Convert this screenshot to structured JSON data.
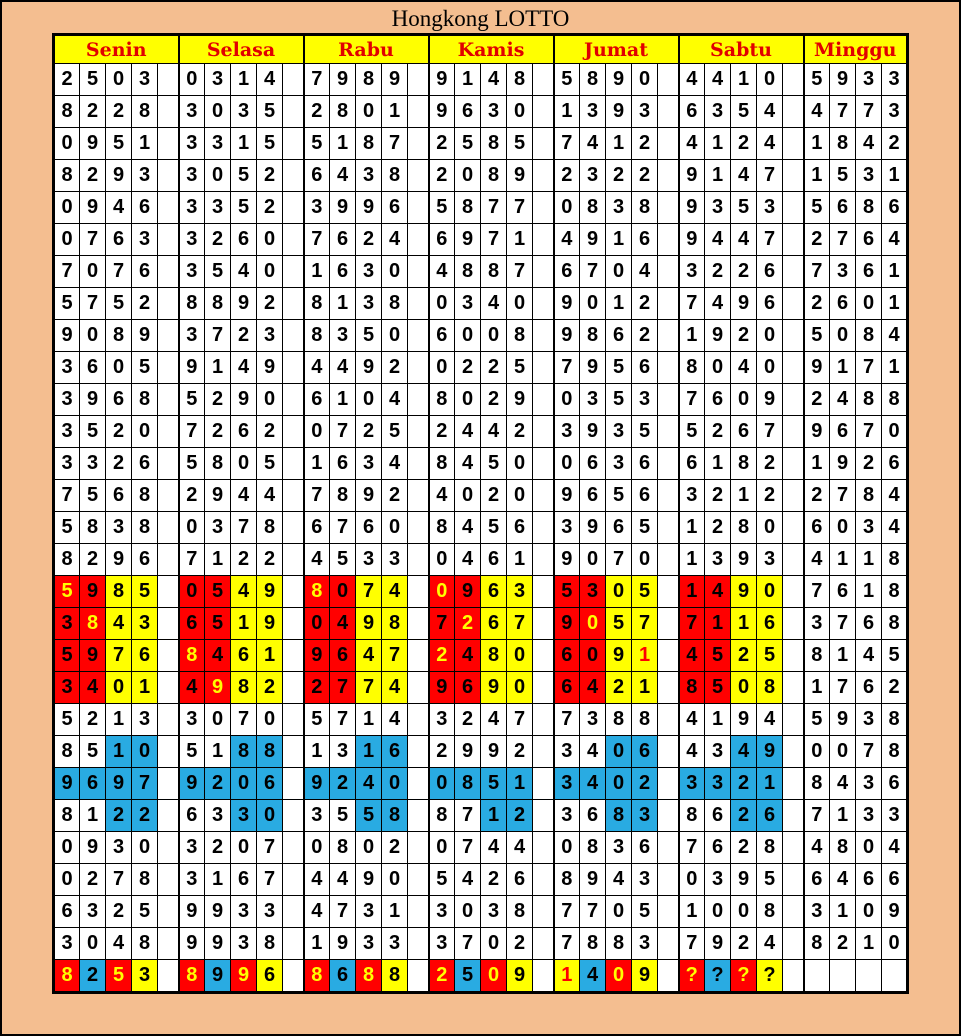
{
  "chart_data": {
    "type": "table",
    "title": "Hongkong LOTTO",
    "columns": [
      "Senin",
      "Selasa",
      "Rabu",
      "Kamis",
      "Jumat",
      "Sabtu",
      "Minggu"
    ],
    "cell_codes": {
      "bg": {
        "w": "white",
        "r": "red",
        "y": "yellow",
        "u": "blue"
      },
      "fg": {
        "k": "black",
        "y": "yellow",
        "r": "red"
      }
    },
    "colors": {
      "background": "#F4BE90",
      "grid": "#000000",
      "title_text": "#000000",
      "header_bg": "#FFFF00",
      "header_text": "#E10000",
      "cell_white": "#FFFFFF",
      "digit_text": "#000000",
      "highlight_red": "#FF0000",
      "highlight_yellow": "#FFFF00",
      "highlight_blue": "#29ABE2"
    },
    "rows": [
      [
        {
          "d": "2503"
        },
        {
          "d": "0314"
        },
        {
          "d": "7989"
        },
        {
          "d": "9148"
        },
        {
          "d": "5890"
        },
        {
          "d": "4410"
        },
        {
          "d": "5933"
        }
      ],
      [
        {
          "d": "8228"
        },
        {
          "d": "3035"
        },
        {
          "d": "2801"
        },
        {
          "d": "9630"
        },
        {
          "d": "1393"
        },
        {
          "d": "6354"
        },
        {
          "d": "4773"
        }
      ],
      [
        {
          "d": "0951"
        },
        {
          "d": "3315"
        },
        {
          "d": "5187"
        },
        {
          "d": "2585"
        },
        {
          "d": "7412"
        },
        {
          "d": "4124"
        },
        {
          "d": "1842"
        }
      ],
      [
        {
          "d": "8293"
        },
        {
          "d": "3052"
        },
        {
          "d": "6438"
        },
        {
          "d": "2089"
        },
        {
          "d": "2322"
        },
        {
          "d": "9147"
        },
        {
          "d": "1531"
        }
      ],
      [
        {
          "d": "0946"
        },
        {
          "d": "3352"
        },
        {
          "d": "3996"
        },
        {
          "d": "5877"
        },
        {
          "d": "0838"
        },
        {
          "d": "9353"
        },
        {
          "d": "5686"
        }
      ],
      [
        {
          "d": "0763"
        },
        {
          "d": "3260"
        },
        {
          "d": "7624"
        },
        {
          "d": "6971"
        },
        {
          "d": "4916"
        },
        {
          "d": "9447"
        },
        {
          "d": "2764"
        }
      ],
      [
        {
          "d": "7076"
        },
        {
          "d": "3540"
        },
        {
          "d": "1630"
        },
        {
          "d": "4887"
        },
        {
          "d": "6704"
        },
        {
          "d": "3226"
        },
        {
          "d": "7361"
        }
      ],
      [
        {
          "d": "5752"
        },
        {
          "d": "8892"
        },
        {
          "d": "8138"
        },
        {
          "d": "0340"
        },
        {
          "d": "9012"
        },
        {
          "d": "7496"
        },
        {
          "d": "2601"
        }
      ],
      [
        {
          "d": "9089"
        },
        {
          "d": "3723"
        },
        {
          "d": "8350"
        },
        {
          "d": "6008"
        },
        {
          "d": "9862"
        },
        {
          "d": "1920"
        },
        {
          "d": "5084"
        }
      ],
      [
        {
          "d": "3605"
        },
        {
          "d": "9149"
        },
        {
          "d": "4492"
        },
        {
          "d": "0225"
        },
        {
          "d": "7956"
        },
        {
          "d": "8040"
        },
        {
          "d": "9171"
        }
      ],
      [
        {
          "d": "3968"
        },
        {
          "d": "5290"
        },
        {
          "d": "6104"
        },
        {
          "d": "8029"
        },
        {
          "d": "0353"
        },
        {
          "d": "7609"
        },
        {
          "d": "2488"
        }
      ],
      [
        {
          "d": "3520"
        },
        {
          "d": "7262"
        },
        {
          "d": "0725"
        },
        {
          "d": "2442"
        },
        {
          "d": "3935"
        },
        {
          "d": "5267"
        },
        {
          "d": "9670"
        }
      ],
      [
        {
          "d": "3326"
        },
        {
          "d": "5805"
        },
        {
          "d": "1634"
        },
        {
          "d": "8450"
        },
        {
          "d": "0636"
        },
        {
          "d": "6182"
        },
        {
          "d": "1926"
        }
      ],
      [
        {
          "d": "7568"
        },
        {
          "d": "2944"
        },
        {
          "d": "7892"
        },
        {
          "d": "4020"
        },
        {
          "d": "9656"
        },
        {
          "d": "3212"
        },
        {
          "d": "2784"
        }
      ],
      [
        {
          "d": "5838"
        },
        {
          "d": "0378"
        },
        {
          "d": "6760"
        },
        {
          "d": "8456"
        },
        {
          "d": "3965"
        },
        {
          "d": "1280"
        },
        {
          "d": "6034"
        }
      ],
      [
        {
          "d": "8296"
        },
        {
          "d": "7122"
        },
        {
          "d": "4533"
        },
        {
          "d": "0461"
        },
        {
          "d": "9070"
        },
        {
          "d": "1393"
        },
        {
          "d": "4118"
        }
      ],
      [
        {
          "d": "5985",
          "bg": "rryy",
          "fg": "ykkk"
        },
        {
          "d": "0549",
          "bg": "rryy"
        },
        {
          "d": "8074",
          "bg": "rryy",
          "fg": "ykkk"
        },
        {
          "d": "0963",
          "bg": "rryy",
          "fg": "ykkk"
        },
        {
          "d": "5305",
          "bg": "rryy"
        },
        {
          "d": "1490",
          "bg": "rryy"
        },
        {
          "d": "7618"
        }
      ],
      [
        {
          "d": "3843",
          "bg": "rryy",
          "fg": "kykk"
        },
        {
          "d": "6519",
          "bg": "rryy"
        },
        {
          "d": "0498",
          "bg": "rryy"
        },
        {
          "d": "7267",
          "bg": "rryy",
          "fg": "kykk"
        },
        {
          "d": "9057",
          "bg": "rryy",
          "fg": "kykk"
        },
        {
          "d": "7116",
          "bg": "rryy"
        },
        {
          "d": "3768"
        }
      ],
      [
        {
          "d": "5976",
          "bg": "rryy"
        },
        {
          "d": "8461",
          "bg": "rryy",
          "fg": "ykkk"
        },
        {
          "d": "9647",
          "bg": "rryy"
        },
        {
          "d": "2480",
          "bg": "rryy",
          "fg": "ykkk"
        },
        {
          "d": "6091",
          "bg": "rryy",
          "fg": "kkkr"
        },
        {
          "d": "4525",
          "bg": "rryy"
        },
        {
          "d": "8145"
        }
      ],
      [
        {
          "d": "3401",
          "bg": "rryy"
        },
        {
          "d": "4982",
          "bg": "rryy",
          "fg": "kykk"
        },
        {
          "d": "2774",
          "bg": "rryy"
        },
        {
          "d": "9690",
          "bg": "rryy"
        },
        {
          "d": "6421",
          "bg": "rryy"
        },
        {
          "d": "8508",
          "bg": "rryy"
        },
        {
          "d": "1762"
        }
      ],
      [
        {
          "d": "5213"
        },
        {
          "d": "3070"
        },
        {
          "d": "5714"
        },
        {
          "d": "3247"
        },
        {
          "d": "7388"
        },
        {
          "d": "4194"
        },
        {
          "d": "5938"
        }
      ],
      [
        {
          "d": "8510",
          "bg": "wwuu"
        },
        {
          "d": "5188",
          "bg": "wwuu"
        },
        {
          "d": "1316",
          "bg": "wwuu"
        },
        {
          "d": "2992"
        },
        {
          "d": "3406",
          "bg": "wwuu"
        },
        {
          "d": "4349",
          "bg": "wwuu"
        },
        {
          "d": "0078"
        }
      ],
      [
        {
          "d": "9697",
          "bg": "uuuu"
        },
        {
          "d": "9206",
          "bg": "uuuu"
        },
        {
          "d": "9240",
          "bg": "uuuu"
        },
        {
          "d": "0851",
          "bg": "uuuu"
        },
        {
          "d": "3402",
          "bg": "uuuu"
        },
        {
          "d": "3321",
          "bg": "uuuu"
        },
        {
          "d": "8436"
        }
      ],
      [
        {
          "d": "8122",
          "bg": "wwuu"
        },
        {
          "d": "6330",
          "bg": "wwuu"
        },
        {
          "d": "3558",
          "bg": "wwuu"
        },
        {
          "d": "8712",
          "bg": "wwuu"
        },
        {
          "d": "3683",
          "bg": "wwuu"
        },
        {
          "d": "8626",
          "bg": "wwuu"
        },
        {
          "d": "7133"
        }
      ],
      [
        {
          "d": "0930"
        },
        {
          "d": "3207"
        },
        {
          "d": "0802"
        },
        {
          "d": "0744"
        },
        {
          "d": "0836"
        },
        {
          "d": "7628"
        },
        {
          "d": "4804"
        }
      ],
      [
        {
          "d": "0278"
        },
        {
          "d": "3167"
        },
        {
          "d": "4490"
        },
        {
          "d": "5426"
        },
        {
          "d": "8943"
        },
        {
          "d": "0395"
        },
        {
          "d": "6466"
        }
      ],
      [
        {
          "d": "6325"
        },
        {
          "d": "9933"
        },
        {
          "d": "4731"
        },
        {
          "d": "3038"
        },
        {
          "d": "7705"
        },
        {
          "d": "1008"
        },
        {
          "d": "3109"
        }
      ],
      [
        {
          "d": "3048"
        },
        {
          "d": "9938"
        },
        {
          "d": "1933"
        },
        {
          "d": "3702"
        },
        {
          "d": "7883"
        },
        {
          "d": "7924"
        },
        {
          "d": "8210"
        }
      ],
      [
        {
          "d": "8253",
          "bg": "rury",
          "fg": "ykyk"
        },
        {
          "d": "8996",
          "bg": "rury",
          "fg": "ykyk"
        },
        {
          "d": "8688",
          "bg": "rury",
          "fg": "ykyk"
        },
        {
          "d": "2509",
          "bg": "rury",
          "fg": "ykyk"
        },
        {
          "d": "1409",
          "bg": "yury",
          "fg": "rkyk"
        },
        {
          "d": "????",
          "bg": "rury",
          "fg": "ykyk"
        },
        {
          "d": ""
        }
      ]
    ]
  }
}
